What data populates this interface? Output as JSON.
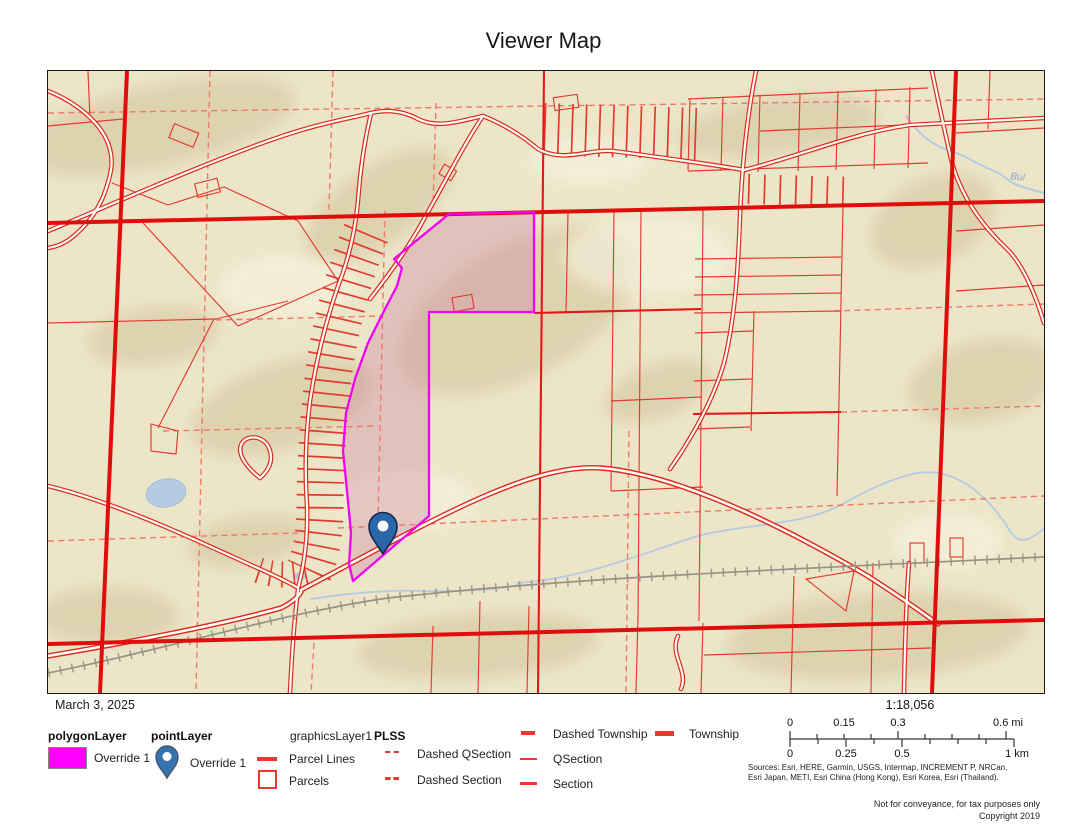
{
  "title": "Viewer Map",
  "date": "March 3, 2025",
  "map": {
    "stream_label": "Bul",
    "colors": {
      "base_tan": "#ece5c8",
      "hillshade_tan": "#d0c096",
      "parcel_red": "#e23b2f",
      "township_red": "#e00d0d",
      "dashed_red": "#ee7a6a",
      "highlight_magenta": "#f103f1",
      "polygon_fill": "rgba(202,122,160,0.33)",
      "water_blue": "#b5cbe2",
      "pin_blue": "#2b66a8",
      "railroad_gray": "#9c9082"
    }
  },
  "legend": {
    "polygon_layer": {
      "name": "polygonLayer",
      "item_label": "Override 1"
    },
    "point_layer": {
      "name": "pointLayer",
      "item_label": "Override 1"
    },
    "graphics_layer": {
      "name": "graphicsLayer1",
      "items": [
        {
          "label": "Parcel Lines"
        },
        {
          "label": "Parcels"
        }
      ]
    },
    "plss": {
      "name": "PLSS",
      "items": [
        {
          "label": "Dashed QSection"
        },
        {
          "label": "Dashed Section"
        },
        {
          "label": "Dashed Township"
        },
        {
          "label": "QSection"
        },
        {
          "label": "Section"
        },
        {
          "label": "Township"
        }
      ]
    }
  },
  "scale": {
    "ratio": "1:18,056",
    "mi_labels": [
      "0",
      "0.15",
      "0.3",
      "0.6 mi"
    ],
    "km_labels": [
      "0",
      "0.25",
      "0.5",
      "1 km"
    ]
  },
  "attribution": {
    "sources_line1": "Sources:  Esri,  HERE,  Garmin,  USGS,  Intermap, INCREMENT P, NRCan,",
    "sources_line2": "Esri Japan, METI, Esri China (Hong Kong), Esri Korea, Esri (Thailand).",
    "disclaimer": "Not for conveyance, for tax purposes only",
    "copyright": "Copyright 2019"
  }
}
